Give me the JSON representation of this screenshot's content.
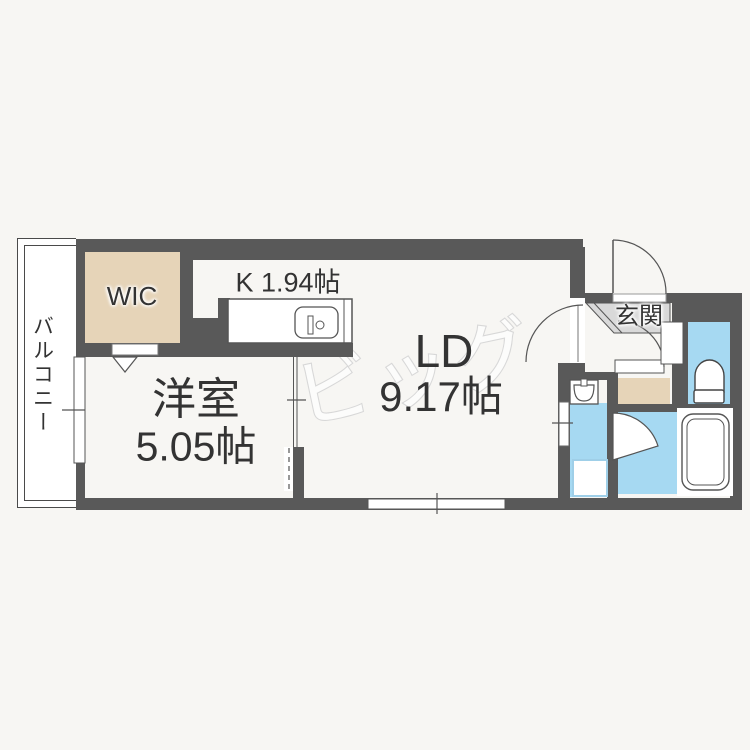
{
  "plan": {
    "watermark": "ビッグ",
    "rooms": {
      "wic": {
        "label": "WIC"
      },
      "kitchen": {
        "label": "K 1.94帖"
      },
      "living_dining": {
        "label": "LD",
        "size": "9.17帖"
      },
      "western_room": {
        "label": "洋室",
        "size": "5.05帖"
      },
      "entrance": {
        "label": "玄関"
      },
      "balcony": {
        "label": "バルコニー"
      }
    },
    "colors": {
      "wall": "#595959",
      "wic_floor": "#e6d4b8",
      "wet_area_floor": "#a6d9f2",
      "entrance_tile": "#d9d9d9",
      "watermark": "#d8d8d8",
      "background": "#f7f6f3"
    }
  }
}
